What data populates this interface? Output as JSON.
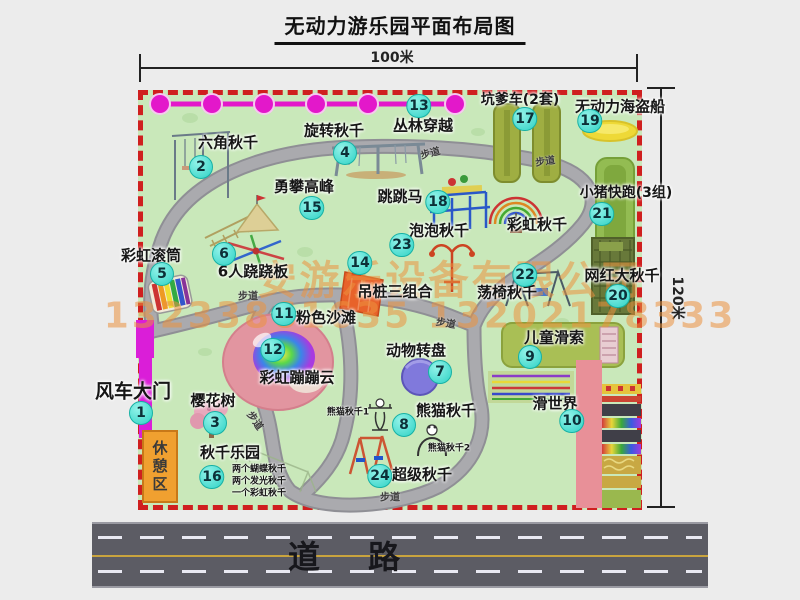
{
  "title": "无动力游乐园平面布局图",
  "dimensions": {
    "width_label": "100米",
    "height_label": "120米"
  },
  "road": {
    "label": "道路"
  },
  "watermark": {
    "company": "安游乐设备有限公司",
    "phone": "13233861635 13202178333"
  },
  "trail_label": "步道",
  "rest_area": {
    "label": "休憩区"
  },
  "rainbow_swing": {
    "label": "彩虹秋千"
  },
  "sub_labels": {
    "swing_paradise": [
      "两个蝴蝶秋千",
      "两个发光秋千",
      "一个彩虹秋千"
    ],
    "panda_1": "熊猫秋千1",
    "panda_2": "熊猫秋千2"
  },
  "attractions": [
    {
      "num": "1",
      "label": "风车大门"
    },
    {
      "num": "2",
      "label": "六角秋千"
    },
    {
      "num": "3",
      "label": "樱花树"
    },
    {
      "num": "4",
      "label": "旋转秋千"
    },
    {
      "num": "5",
      "label": "彩虹滚筒"
    },
    {
      "num": "6",
      "label": "6人跷跷板"
    },
    {
      "num": "7",
      "label": "动物转盘"
    },
    {
      "num": "8",
      "label": "熊猫秋千"
    },
    {
      "num": "9",
      "label": "儿童滑索"
    },
    {
      "num": "10",
      "label": "滑世界"
    },
    {
      "num": "11",
      "label": "粉色沙滩"
    },
    {
      "num": "12",
      "label": "彩虹蹦蹦云"
    },
    {
      "num": "13",
      "label": "丛林穿越"
    },
    {
      "num": "14",
      "label": "吊桩三组合"
    },
    {
      "num": "15",
      "label": "勇攀高峰"
    },
    {
      "num": "16",
      "label": "秋千乐园"
    },
    {
      "num": "17",
      "label": "坑爹车(2套)"
    },
    {
      "num": "18",
      "label": "跳跳马"
    },
    {
      "num": "19",
      "label": "无动力海盗船"
    },
    {
      "num": "20",
      "label": "网红大秋千"
    },
    {
      "num": "21",
      "label": "小猪快跑(3组)"
    },
    {
      "num": "22",
      "label": "荡椅秋千"
    },
    {
      "num": "23",
      "label": "泡泡秋千"
    },
    {
      "num": "24",
      "label": "超级秋千"
    }
  ],
  "colors": {
    "badge_cyan": "#2ed2c5",
    "border_red": "#cf1f1f",
    "park_green": "#c9e8ba",
    "path_gray": "#aaaaae",
    "gate_magenta": "#da1ed8",
    "rest_orange": "#f0a030",
    "watermark_orange": "#eb923e",
    "road_gray": "#5c5c64"
  }
}
